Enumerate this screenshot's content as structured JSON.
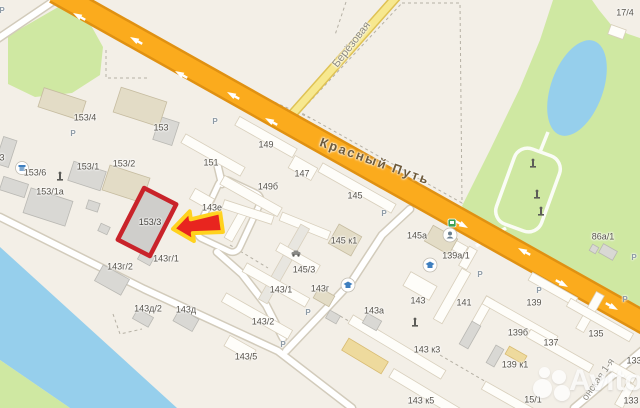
{
  "map": {
    "streets": {
      "main": "Красный Путь",
      "secondary": "Берёзовая",
      "tertiary": "онская 1-я"
    },
    "highlight": {
      "label": "153/3"
    },
    "watermark": {
      "text": "Avito"
    },
    "parking_symbol": "Р",
    "parking_markers": [
      {
        "x": 2,
        "y": 11
      },
      {
        "x": 73,
        "y": 134
      },
      {
        "x": 215,
        "y": 122
      },
      {
        "x": 384,
        "y": 214
      },
      {
        "x": 480,
        "y": 275
      },
      {
        "x": 539,
        "y": 291
      },
      {
        "x": 308,
        "y": 313
      },
      {
        "x": 283,
        "y": 345
      },
      {
        "x": 634,
        "y": 258
      },
      {
        "x": 625,
        "y": 300
      }
    ],
    "building_labels": [
      {
        "t": "153/4",
        "x": 85,
        "y": 118
      },
      {
        "t": "153",
        "x": 161,
        "y": 128
      },
      {
        "t": "153/1",
        "x": 88,
        "y": 167
      },
      {
        "t": "153/2",
        "x": 124,
        "y": 164
      },
      {
        "t": "153/6",
        "x": 35,
        "y": 173
      },
      {
        "t": "153/1а",
        "x": 50,
        "y": 192
      },
      {
        "t": "3",
        "x": 2,
        "y": 158
      },
      {
        "t": "151",
        "x": 211,
        "y": 163
      },
      {
        "t": "149",
        "x": 266,
        "y": 145
      },
      {
        "t": "147",
        "x": 302,
        "y": 174
      },
      {
        "t": "149б",
        "x": 268,
        "y": 187
      },
      {
        "t": "145",
        "x": 355,
        "y": 196
      },
      {
        "t": "143е",
        "x": 212,
        "y": 208
      },
      {
        "t": "145 к1",
        "x": 344,
        "y": 241
      },
      {
        "t": "145а",
        "x": 417,
        "y": 236
      },
      {
        "t": "139а/1",
        "x": 456,
        "y": 256
      },
      {
        "t": "86а/1",
        "x": 603,
        "y": 237
      },
      {
        "t": "17/4",
        "x": 625,
        "y": 13
      },
      {
        "t": "143г/1",
        "x": 166,
        "y": 259
      },
      {
        "t": "143г/2",
        "x": 120,
        "y": 267
      },
      {
        "t": "145/3",
        "x": 304,
        "y": 270
      },
      {
        "t": "143/1",
        "x": 281,
        "y": 290
      },
      {
        "t": "143г",
        "x": 320,
        "y": 289
      },
      {
        "t": "143/2",
        "x": 263,
        "y": 322
      },
      {
        "t": "143д/2",
        "x": 148,
        "y": 309
      },
      {
        "t": "143д",
        "x": 186,
        "y": 310
      },
      {
        "t": "143а",
        "x": 374,
        "y": 311
      },
      {
        "t": "143",
        "x": 418,
        "y": 301
      },
      {
        "t": "141",
        "x": 464,
        "y": 303
      },
      {
        "t": "139",
        "x": 534,
        "y": 303
      },
      {
        "t": "143/5",
        "x": 246,
        "y": 357
      },
      {
        "t": "143 к3",
        "x": 427,
        "y": 350
      },
      {
        "t": "139б",
        "x": 518,
        "y": 333
      },
      {
        "t": "137",
        "x": 551,
        "y": 343
      },
      {
        "t": "135",
        "x": 596,
        "y": 334
      },
      {
        "t": "139 к1",
        "x": 515,
        "y": 365
      },
      {
        "t": "143 к5",
        "x": 421,
        "y": 401
      },
      {
        "t": "15/1",
        "x": 533,
        "y": 400
      },
      {
        "t": "133",
        "x": 634,
        "y": 361
      },
      {
        "t": "133",
        "x": 631,
        "y": 401
      }
    ],
    "icons": [
      "monument-icon",
      "bus-stop-icon",
      "person-service-icon",
      "education-icon",
      "shop-icon",
      "car-icon",
      "red-arrow-icon"
    ],
    "colors": {
      "background": "#f3efe7",
      "highway_orange": "#fbab1d",
      "highway_casing": "#e09112",
      "minor_road_yellow": "#f7e88f",
      "park_green": "#cfe8a2",
      "water_blue": "#96cfec",
      "highlight_red": "#c9232a",
      "arrow_red": "#e8251f",
      "arrow_outline": "#ffd21e"
    }
  }
}
